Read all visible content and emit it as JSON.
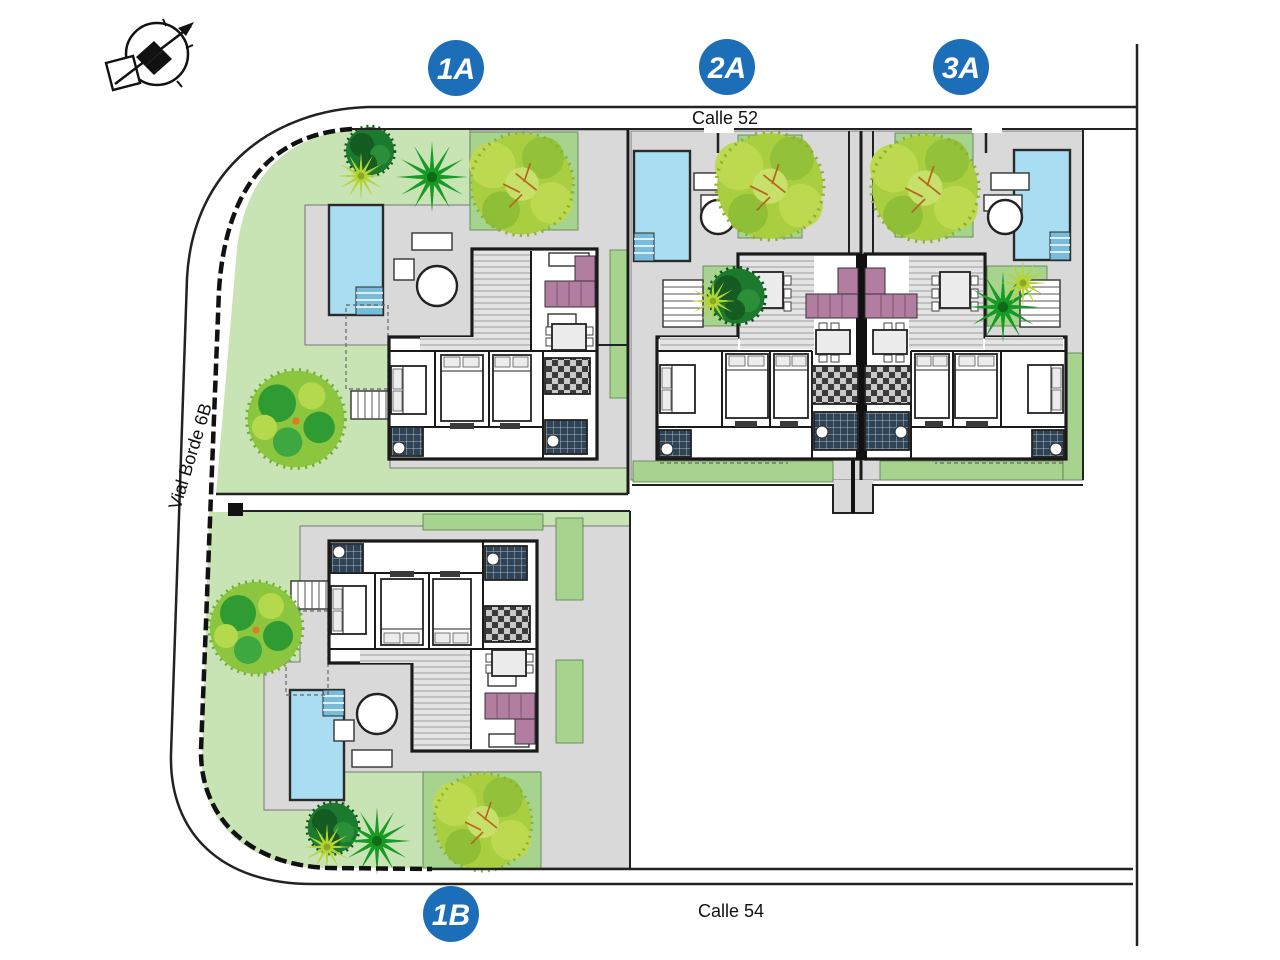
{
  "plots": [
    {
      "label": "1A"
    },
    {
      "label": "2A"
    },
    {
      "label": "3A"
    },
    {
      "label": "1B"
    }
  ],
  "streets": {
    "top": "Calle 52",
    "bottom": "Calle 54",
    "left": "Vial Borde 6B"
  },
  "icons": {
    "compass": "north-arrow-compass-icon"
  },
  "colors": {
    "badge_blue": "#1d6eb8",
    "lawn": "#c8e3b4",
    "garden_patch": "#a6d48e",
    "terrace": "#d9d9d9",
    "pool_water": "#a9ddf2",
    "sofa_pink": "#b17da0",
    "tree_light": "#a9ce3f",
    "tree_mid": "#8cc63f",
    "tree_dark": "#169a24",
    "bush_dark": "#1c7a2e",
    "line_black": "#1a1a1a"
  }
}
